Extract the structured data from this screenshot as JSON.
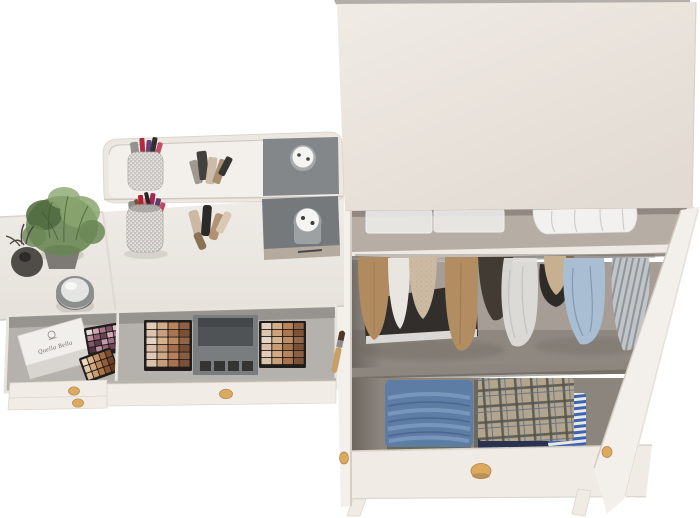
{
  "image": {
    "kind": "3d-furniture-product-render",
    "subject": "Top-down view of a cream dressing table with open cosmetic drawers beside an open two-door wardrobe with clothes",
    "background": "#ffffff"
  },
  "vanity": {
    "box_label": "Quella Bella",
    "colors": {
      "surface": "#eae6e1",
      "surface_edge": "#d8d2cb",
      "mirror_frame": "#ece7e1",
      "mirror_face": "#f3f0ec",
      "drawer_interior": "#b5b1ad",
      "drawer_wall": "#e9e4de",
      "front": "#f1ece6",
      "knob": "#dba95f",
      "knob_dark": "#a97c3f",
      "kit_case": "#797d80",
      "kit_mirror": "#4f5356",
      "palette_frame": "#201e1d",
      "pad_gray": "#75797c",
      "pad_strip": "#b4aa9d",
      "jar_white": "#f5f5f3",
      "jar_side": "#9ea1a3",
      "cup_silver": "#c6c3bf",
      "box_white": "#f1efec",
      "plant_green": "#6a8755",
      "plant_green_dark": "#4e683d",
      "plant_green_light": "#8aa56f",
      "pot_gray": "#7d7a76",
      "vase_dark": "#504c48",
      "candle_ring": "#8c8e8d",
      "candle_top": "#e4e5e3"
    },
    "lipsticks": [
      "#8d8d8b",
      "#b22038",
      "#d4607e",
      "#a32750",
      "#5e3a6f",
      "#262626",
      "#c24660",
      "#7c4b30"
    ],
    "palette_pink_shades": [
      "#e9d8dc",
      "#cfa6b2",
      "#aa7588",
      "#7f5064",
      "#ddc1c7",
      "#be8d9c",
      "#946074",
      "#6c4254",
      "#d2aab6",
      "#b07e90",
      "#875667",
      "#5f3a4a",
      "#c49aa8",
      "#a06f82",
      "#7a4c5e",
      "#553342",
      "#b98fa0",
      "#956478",
      "#704355",
      "#4e2d3b"
    ],
    "palette_nude_shades": [
      "#ecd6ba",
      "#dab58e",
      "#c29064",
      "#a06a42",
      "#7c4c2c",
      "#e4c9a9",
      "#d0a67c",
      "#b68154",
      "#935d38",
      "#6f4226",
      "#dcbd9b",
      "#c6996e",
      "#aa7448",
      "#875230",
      "#633a20"
    ],
    "kit_left_shades": [
      "#e2cdbb",
      "#d3ad8a",
      "#b9835c",
      "#8f6044",
      "#dcc4ae",
      "#c9a07b",
      "#a87550",
      "#7c5034",
      "#e6d2c0",
      "#d6b18e",
      "#bd8960",
      "#936547",
      "#d8bfa8",
      "#c69b75",
      "#a56f4b",
      "#774d31",
      "#e0cab6",
      "#d0a984",
      "#b68059",
      "#8a5d41",
      "#dac2ab",
      "#c89e79",
      "#a7724e",
      "#7b5035"
    ],
    "kit_right_shades": [
      "#e5d0bd",
      "#d5ae88",
      "#bb8459",
      "#8f6142",
      "#ddc5ad",
      "#cba27a",
      "#aa7750",
      "#7e5233",
      "#e8d4c2",
      "#d8b390",
      "#bf8b61",
      "#956747",
      "#dabfa6",
      "#c89d74",
      "#a7714a",
      "#795031",
      "#e2ccb6",
      "#d2ab85",
      "#b8825a",
      "#8c5f40",
      "#dcc4aa",
      "#ca9f77",
      "#a9744d",
      "#7d5234"
    ]
  },
  "wardrobe": {
    "colors": {
      "top_panel": "#e8e2db",
      "top_panel_light": "#f0ebe5",
      "top_edge": "#b3aeaa",
      "interior_top_wall": "#b6ada5",
      "interior_mid_wall": "#a59d96",
      "interior_floor": "#8f8881",
      "interior_drawer": "#8b857d",
      "interior_shadow": "#6b655e",
      "shelf_edge": "#eee9e3",
      "side_panel": "#e3ddd6",
      "door": "#f3efea",
      "front": "#f0ebe5",
      "knob": "#dba95f",
      "dark_box": "#312e2b",
      "dark_box_strip": "#dad8d4",
      "bin_white": "#ebebe9",
      "basket_white": "#f2f1ef",
      "denim": "#5e7da4",
      "denim_light": "#7e9cc0",
      "khaki": "#6b6950",
      "plaid": "#b2a58d",
      "plaid_dark": "#53524b",
      "navy": "#293250",
      "stripe_blue": "#3b63b0",
      "stripe_white": "#e8e8e6"
    },
    "garments": [
      {
        "name": "tan-coat",
        "color": "#b18b60"
      },
      {
        "name": "white-top",
        "color": "#e9e6e1"
      },
      {
        "name": "knit-shirt",
        "color": "#cdbaa2"
      },
      {
        "name": "camel-coat",
        "color": "#b28d62"
      },
      {
        "name": "dark-coat",
        "color": "#413b34"
      },
      {
        "name": "garment-bag",
        "color": "#deddda"
      },
      {
        "name": "black-bag",
        "color": "#2e2b28"
      },
      {
        "name": "beige-sweater",
        "color": "#c7b08f"
      },
      {
        "name": "blue-shirt",
        "color": "#a9bed3"
      },
      {
        "name": "striped-shirt",
        "color": "#c1c5c8"
      }
    ]
  }
}
